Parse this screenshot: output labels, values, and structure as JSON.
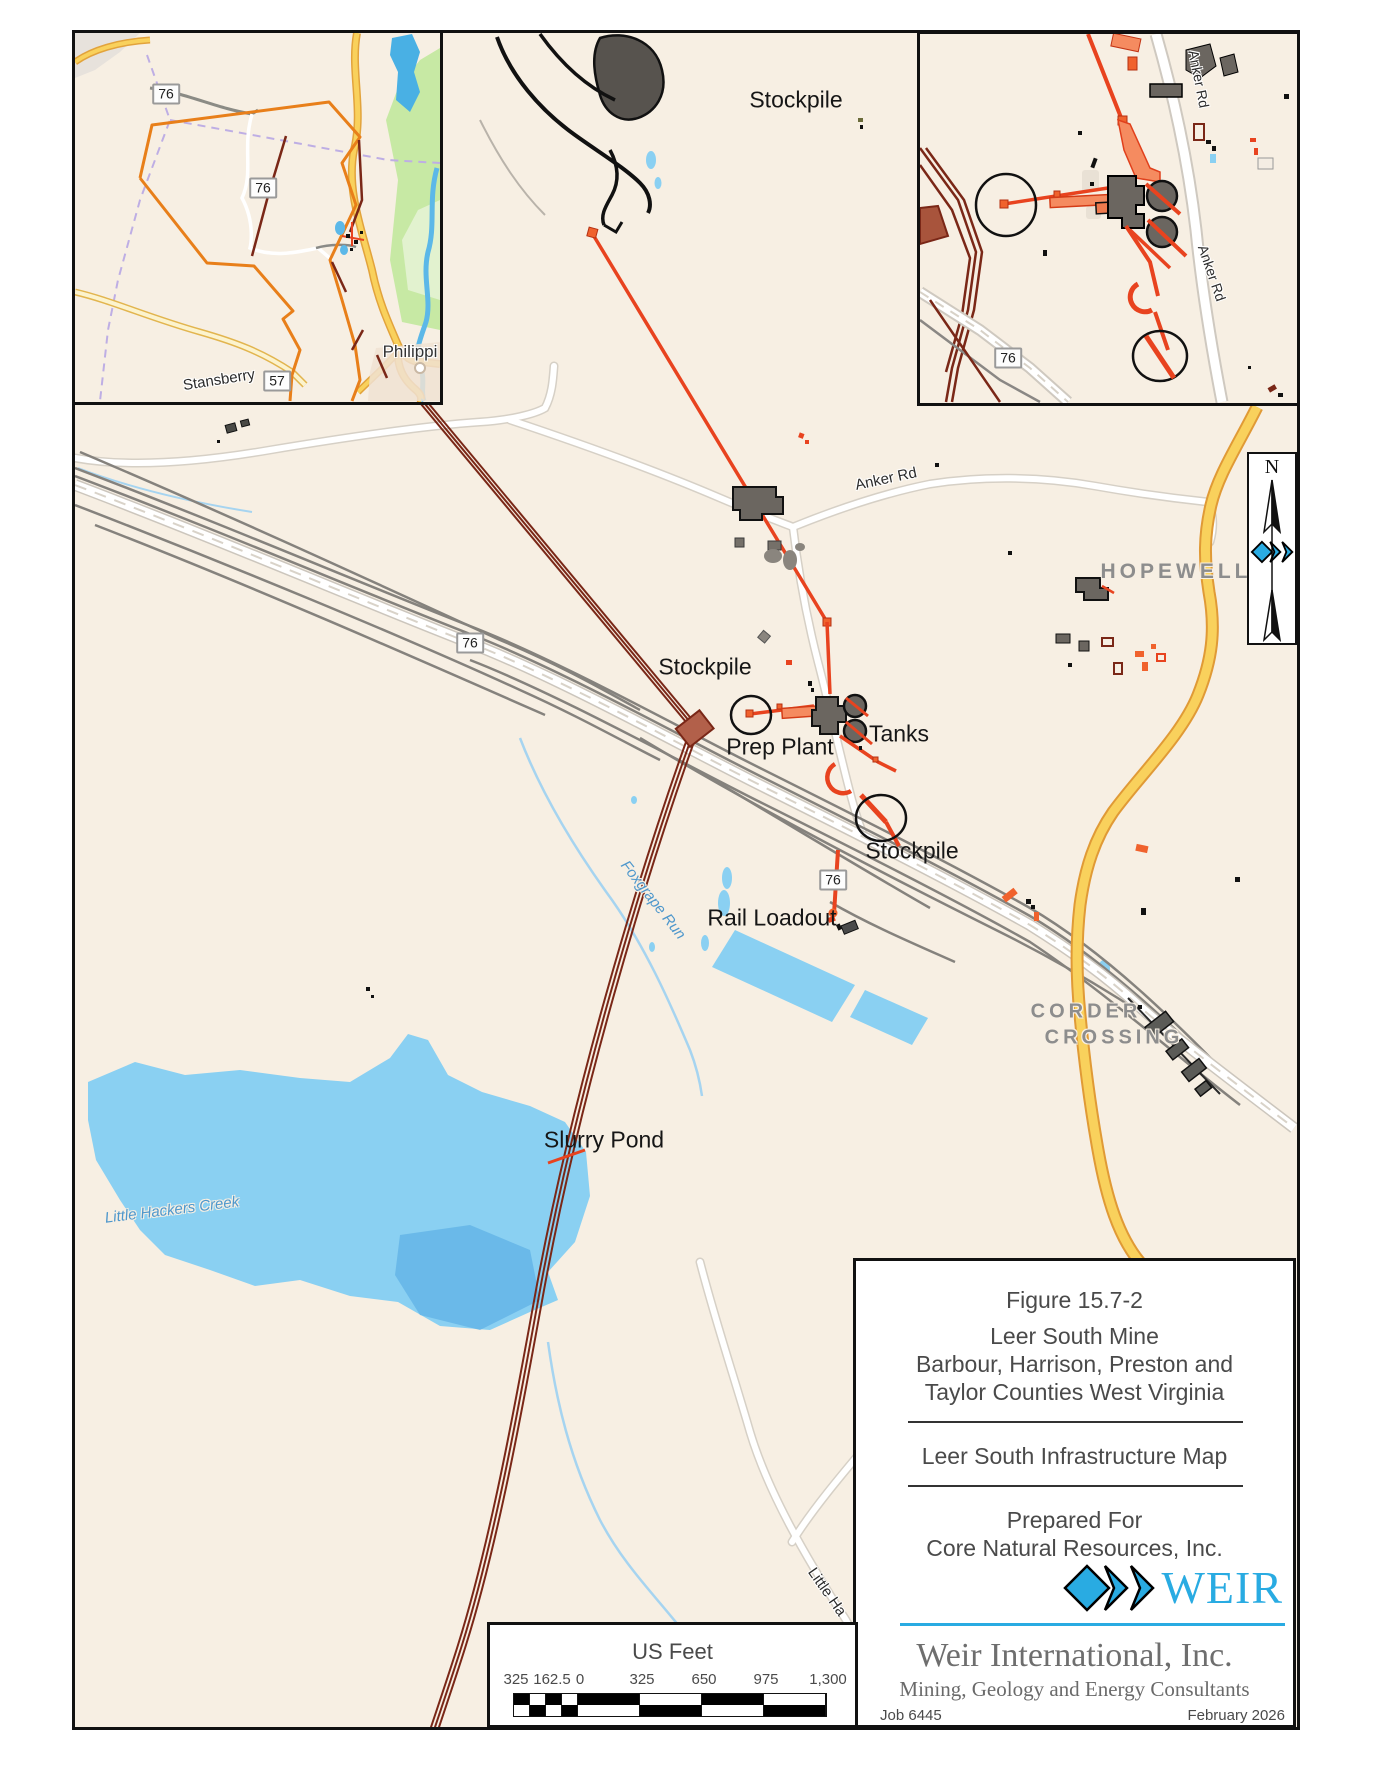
{
  "map": {
    "labels": {
      "stockpile": "Stockpile",
      "prep_plant": "Prep Plant",
      "tanks": "Tanks",
      "rail_loadout": "Rail Loadout",
      "slurry_pond": "Slurry Pond",
      "hopewell": "HOPEWELL",
      "corder": "CORDER",
      "crossing": "CROSSING",
      "anker_rd": "Anker Rd",
      "stansberry": "Stansberry",
      "foxgrape_run": "Foxgrape Run",
      "little_hackers_creek": "Little Hackers Creek",
      "little_ha": "Little Ha",
      "route_76": "76",
      "route_57": "57",
      "philippi": "Philippi"
    }
  },
  "north": {
    "n": "N"
  },
  "title_block": {
    "figure": "Figure 15.7-2",
    "line1": "Leer South Mine",
    "line2": "Barbour, Harrison, Preston and",
    "line3": "Taylor Counties West Virginia",
    "map_title": "Leer South Infrastructure Map",
    "prepared_for": "Prepared For",
    "client": "Core Natural Resources, Inc.",
    "logo_text": "WEIR",
    "company": "Weir International, Inc.",
    "tagline": "Mining, Geology and Energy Consultants",
    "job": "Job 6445",
    "date": "February 2026"
  },
  "scale_bar": {
    "units": "US Feet",
    "labels": [
      "325",
      "162.5",
      "0",
      "325",
      "650",
      "975",
      "1,300"
    ]
  },
  "colors": {
    "weir_cyan": "#29abe2",
    "conveyor_red": "#e8431f",
    "pipeline_dark_red": "#7a2717",
    "water_blue": "#8ad0f2",
    "highway_yellow": "#f9d15c",
    "permit_orange": "#e87f1a",
    "land_cream": "#f7efe3"
  }
}
